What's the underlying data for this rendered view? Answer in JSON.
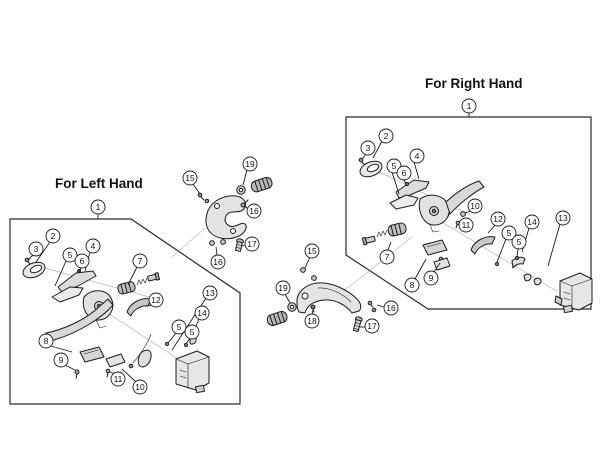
{
  "diagram": {
    "background_color": "#ffffff",
    "line_color": "#1c1c1c",
    "groups": [
      {
        "id": "left-hand",
        "label": "For Left Hand",
        "boundary": [
          [
            10,
            219
          ],
          [
            131,
            219
          ],
          [
            240,
            293
          ],
          [
            240,
            404
          ],
          [
            10,
            404
          ]
        ],
        "group_callout": {
          "n": "1",
          "x": 98,
          "y": 207,
          "lead": [
            [
              98,
              214
            ],
            [
              98,
              219
            ]
          ]
        },
        "callouts": [
          {
            "n": "2",
            "x": 53,
            "y": 236,
            "lead": [
              [
                50,
                242
              ],
              [
                36,
                262
              ]
            ]
          },
          {
            "n": "3",
            "x": 36,
            "y": 249,
            "lead": [
              [
                33,
                255
              ],
              [
                28,
                260
              ]
            ]
          },
          {
            "n": "5",
            "x": 70,
            "y": 255,
            "lead": [
              [
                66,
                261
              ],
              [
                55,
                286
              ]
            ]
          },
          {
            "n": "4",
            "x": 93,
            "y": 246,
            "lead": [
              [
                90,
                252
              ],
              [
                85,
                271
              ]
            ]
          },
          {
            "n": "6",
            "x": 82,
            "y": 261,
            "lead": [
              [
                81,
                268
              ],
              [
                79,
                272
              ]
            ]
          },
          {
            "n": "7",
            "x": 140,
            "y": 261,
            "lead": [
              [
                137,
                267
              ],
              [
                128,
                285
              ]
            ]
          },
          {
            "n": "12",
            "x": 156,
            "y": 300,
            "lead": [
              [
                152,
                305
              ],
              [
                145,
                306
              ]
            ]
          },
          {
            "n": "13",
            "x": 210,
            "y": 293,
            "lead": [
              [
                206,
                298
              ],
              [
                172,
                350
              ]
            ]
          },
          {
            "n": "14",
            "x": 202,
            "y": 313,
            "lead": [
              [
                199,
                319
              ],
              [
                191,
                337
              ]
            ]
          },
          {
            "n": "5",
            "x": 179,
            "y": 327,
            "lead": [
              [
                176,
                333
              ],
              [
                168,
                343
              ]
            ]
          },
          {
            "n": "5",
            "x": 192,
            "y": 332,
            "lead": [
              [
                190,
                338
              ],
              [
                186,
                344
              ]
            ]
          },
          {
            "n": "8",
            "x": 46,
            "y": 341,
            "lead": [
              [
                51,
                346
              ],
              [
                72,
                352
              ]
            ]
          },
          {
            "n": "9",
            "x": 61,
            "y": 360,
            "lead": [
              [
                65,
                365
              ],
              [
                75,
                370
              ]
            ]
          },
          {
            "n": "11",
            "x": 118,
            "y": 379,
            "lead": [
              [
                115,
                374
              ],
              [
                110,
                372
              ]
            ]
          },
          {
            "n": "10",
            "x": 140,
            "y": 387,
            "lead": [
              [
                136,
                382
              ],
              [
                122,
                369
              ]
            ]
          }
        ]
      },
      {
        "id": "right-hand",
        "label": "For Right Hand",
        "boundary": [
          [
            346,
            117
          ],
          [
            591,
            117
          ],
          [
            591,
            309
          ],
          [
            428,
            309
          ],
          [
            346,
            255
          ]
        ],
        "group_callout": {
          "n": "1",
          "x": 469,
          "y": 106,
          "lead": [
            [
              469,
              113
            ],
            [
              469,
              117
            ]
          ]
        },
        "callouts": [
          {
            "n": "2",
            "x": 386,
            "y": 136,
            "lead": [
              [
                382,
                141
              ],
              [
                373,
                158
              ]
            ]
          },
          {
            "n": "3",
            "x": 368,
            "y": 148,
            "lead": [
              [
                366,
                154
              ],
              [
                362,
                159
              ]
            ]
          },
          {
            "n": "4",
            "x": 417,
            "y": 156,
            "lead": [
              [
                414,
                162
              ],
              [
                419,
                179
              ]
            ]
          },
          {
            "n": "5",
            "x": 394,
            "y": 166,
            "lead": [
              [
                392,
                172
              ],
              [
                399,
                194
              ]
            ]
          },
          {
            "n": "6",
            "x": 404,
            "y": 173,
            "lead": [
              [
                404,
                180
              ],
              [
                406,
                184
              ]
            ]
          },
          {
            "n": "10",
            "x": 475,
            "y": 206,
            "lead": [
              [
                471,
                211
              ],
              [
                465,
                213
              ]
            ]
          },
          {
            "n": "11",
            "x": 466,
            "y": 225,
            "lead": [
              [
                462,
                224
              ],
              [
                459,
                223
              ]
            ]
          },
          {
            "n": "7",
            "x": 387,
            "y": 257,
            "lead": [
              [
                388,
                250
              ],
              [
                391,
                242
              ]
            ]
          },
          {
            "n": "8",
            "x": 412,
            "y": 285,
            "lead": [
              [
                415,
                279
              ],
              [
                426,
                259
              ]
            ]
          },
          {
            "n": "9",
            "x": 431,
            "y": 278,
            "lead": [
              [
                434,
                272
              ],
              [
                440,
                263
              ]
            ]
          },
          {
            "n": "12",
            "x": 498,
            "y": 219,
            "lead": [
              [
                495,
                225
              ],
              [
                488,
                233
              ]
            ]
          },
          {
            "n": "14",
            "x": 532,
            "y": 222,
            "lead": [
              [
                529,
                228
              ],
              [
                522,
                252
              ]
            ]
          },
          {
            "n": "5",
            "x": 509,
            "y": 233,
            "lead": [
              [
                506,
                239
              ],
              [
                497,
                262
              ]
            ]
          },
          {
            "n": "5",
            "x": 519,
            "y": 242,
            "lead": [
              [
                518,
                249
              ],
              [
                517,
                257
              ]
            ]
          },
          {
            "n": "13",
            "x": 563,
            "y": 218,
            "lead": [
              [
                560,
                224
              ],
              [
                548,
                266
              ]
            ]
          }
        ]
      }
    ],
    "detached_assemblies": [
      {
        "id": "left-clamp-assembly",
        "callouts": [
          {
            "n": "15",
            "x": 190,
            "y": 178,
            "lead": [
              [
                193,
                184
              ],
              [
                200,
                194
              ]
            ]
          },
          {
            "n": "19",
            "x": 250,
            "y": 164,
            "lead": [
              [
                247,
                170
              ],
              [
                243,
                185
              ]
            ]
          },
          {
            "n": "16",
            "x": 254,
            "y": 211,
            "lead": [
              [
                248,
                209
              ],
              [
                245,
                206
              ]
            ]
          },
          {
            "n": "17",
            "x": 252,
            "y": 244,
            "lead": [
              [
                245,
                245
              ],
              [
                242,
                246
              ]
            ]
          },
          {
            "n": "16",
            "x": 218,
            "y": 262,
            "lead": [
              [
                217,
                255
              ],
              [
                216,
                247
              ]
            ]
          }
        ]
      },
      {
        "id": "right-clamp-assembly",
        "callouts": [
          {
            "n": "15",
            "x": 312,
            "y": 251,
            "lead": [
              [
                310,
                257
              ],
              [
                305,
                268
              ]
            ]
          },
          {
            "n": "19",
            "x": 283,
            "y": 288,
            "lead": [
              [
                285,
                294
              ],
              [
                290,
                303
              ]
            ]
          },
          {
            "n": "18",
            "x": 312,
            "y": 321,
            "lead": [
              [
                312,
                315
              ],
              [
                313,
                310
              ]
            ]
          },
          {
            "n": "16",
            "x": 391,
            "y": 308,
            "lead": [
              [
                384,
                307
              ],
              [
                377,
                305
              ]
            ]
          },
          {
            "n": "17",
            "x": 372,
            "y": 326,
            "lead": [
              [
                365,
                327
              ],
              [
                360,
                327
              ]
            ]
          }
        ]
      }
    ]
  }
}
